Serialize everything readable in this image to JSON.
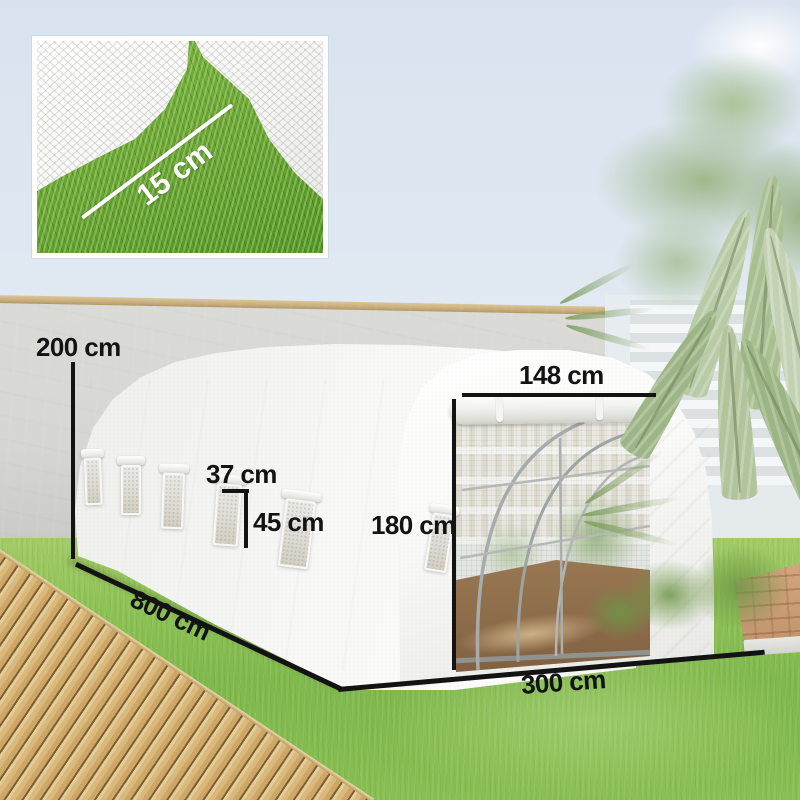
{
  "labels": {
    "wall_height": "200 cm",
    "tunnel_length": "800 cm",
    "tunnel_width": "300 cm",
    "door_width": "148 cm",
    "door_height": "180 cm",
    "window_width": "37 cm",
    "window_height": "45 cm",
    "inset_flap_overlap": "15 cm"
  },
  "colors": {
    "measurement_ink": "#131313",
    "inset_ink": "#ffffff",
    "sky": "#dfe8f2",
    "wall": "#d6d6d3",
    "wall_coping": "#c5ab79",
    "greenhouse_cover": "#f5f5f3",
    "grass": "#7fb84b",
    "deck_wood": "#d9b97e",
    "soil": "#8d6c49",
    "foliage": "#9cb584"
  }
}
